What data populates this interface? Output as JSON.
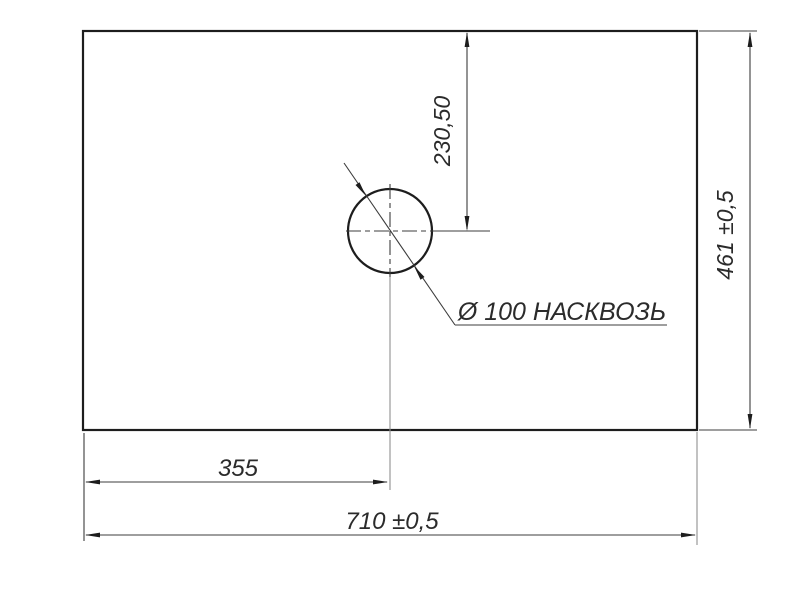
{
  "drawing": {
    "type": "dimension-drawing",
    "labels": {
      "hole_offset_vertical": "230,50",
      "panel_height": "461 ±0,5",
      "hole_offset_horizontal": "355",
      "panel_width": "710 ±0,5",
      "hole_callout": "Ø 100 НАСКВОЗЬ"
    },
    "colors": {
      "outline": "#1d1d1d",
      "dimension": "#3c3c3c",
      "centerline": "#8f8f8f",
      "text": "#2b2b2b",
      "background": "#ffffff"
    }
  }
}
